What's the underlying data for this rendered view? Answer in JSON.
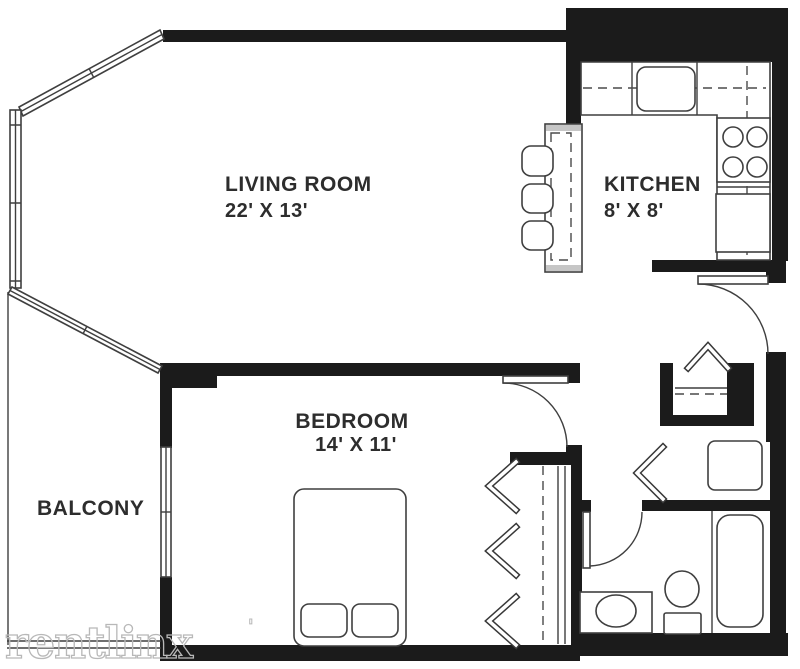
{
  "title": "One-bedroom apartment floor plan",
  "colors": {
    "wall": "#1b1b1b",
    "line": "#3f3f3f",
    "label_text": "#2d2d2d",
    "watermark": "#b8b8b8",
    "counter_cap": "#c6c6c6",
    "background": "#ffffff"
  },
  "rooms": [
    {
      "name": "LIVING ROOM",
      "dims": "22' X 13'"
    },
    {
      "name": "KITCHEN",
      "dims": "8' X 8'"
    },
    {
      "name": "BEDROOM",
      "dims": "14' X 11'"
    },
    {
      "name": "BALCONY",
      "dims": ""
    }
  ],
  "watermark": {
    "text": "rentlinx",
    "mark": "'"
  },
  "fixtures": [
    "kitchen-sink",
    "stove-burners",
    "refrigerator",
    "breakfast-bar",
    "bar-stool",
    "entry-door",
    "bedroom-door",
    "bathroom-door",
    "bed",
    "pillow",
    "bathtub",
    "toilet",
    "bathroom-sink-vanity",
    "closet-chevron",
    "coat-closet-shelf",
    "linen-shelf",
    "bay-window",
    "sliding-glass-door",
    "balcony-railing"
  ]
}
